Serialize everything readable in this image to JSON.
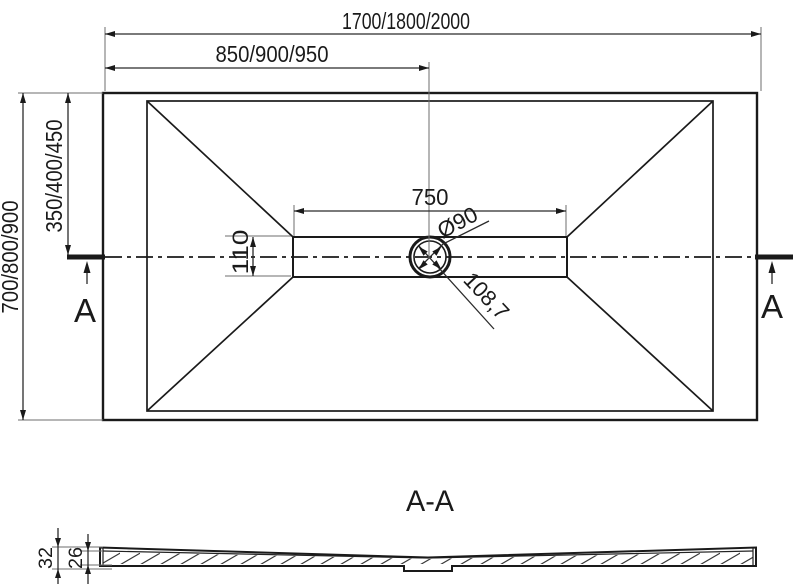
{
  "drawing": {
    "top_view": {
      "dim_width_overall": "1700/1800/2000",
      "dim_width_to_drain": "850/900/950",
      "dim_height_overall": "700/800/900",
      "dim_height_to_drain": "350/400/450",
      "dim_channel_length": "750",
      "dim_channel_width": "110",
      "dim_drain_diameter": "Ø90",
      "dim_drain_diagonal": "108,7",
      "section_marker_left": "A",
      "section_marker_right": "A"
    },
    "section_view": {
      "title": "A-A",
      "dim_total_height": "32",
      "dim_body_height": "26"
    },
    "colors": {
      "line": "#1a1a1a",
      "dimension": "#2b2b2b",
      "extension": "#6e6e6e",
      "background": "#ffffff"
    }
  }
}
